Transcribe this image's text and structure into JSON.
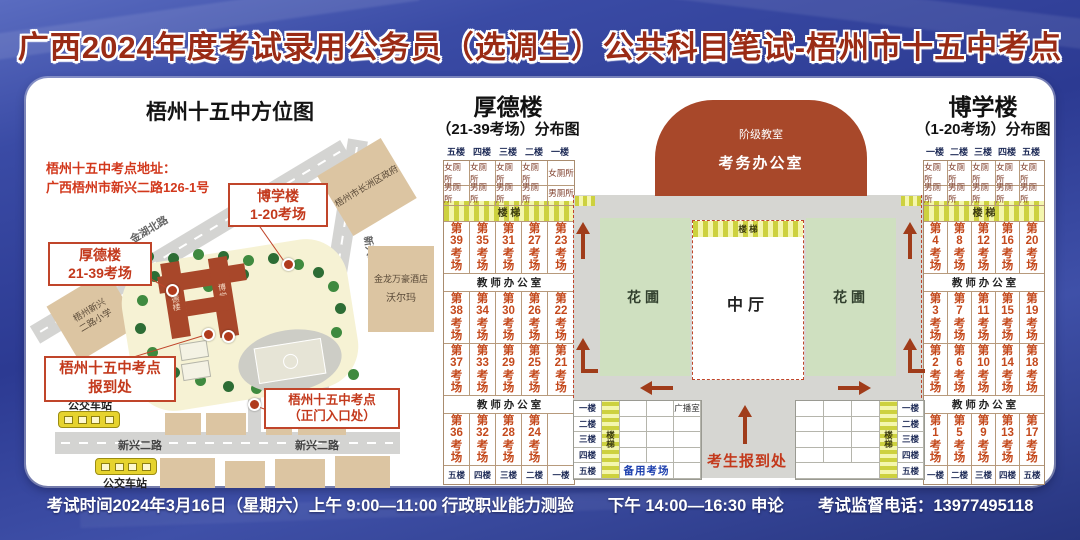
{
  "title": "广西2024年度考试录用公务员（选调生）公共科目笔试-梧州市十五中考点",
  "footer": {
    "time": "考试时间2024年3月16日（星期六）上午 9:00—11:00 行政职业能力测验",
    "afternoon": "下午 14:00—16:30 申论",
    "phone": "考试监督电话：13977495118"
  },
  "colors": {
    "title_red": "#9a2b15",
    "accent_red": "#c3391c",
    "arrow_red": "#a03c1a",
    "stairs_yellow": "#e8eb7a",
    "garden_green": "#cfe0c0",
    "building_brick": "#a8472a",
    "backup_blue": "#1c3fae"
  },
  "map": {
    "title": "梧州十五中方位图",
    "address_line1": "梧州十五中考点地址：",
    "address_line2": "广西梧州市新兴二路126-1号",
    "callout_boxue_line1": "博学楼",
    "callout_boxue_line2": "1-20考场",
    "callout_houde_line1": "厚德楼",
    "callout_houde_line2": "21-39考场",
    "callout_baodao_line1": "梧州十五中考点",
    "callout_baodao_line2": "报到处",
    "callout_gate_line1": "梧州十五中考点",
    "callout_gate_line2": "（正门入口处）",
    "road_jinhu": "金湖北路",
    "road_xinxing_left": "新兴二路",
    "road_xinxing_right": "新兴二路",
    "road_xinxing_vertical": "新兴二路",
    "bldg_government": "梧州市长洲区政府",
    "bldg_hotel": "金龙万豪酒店",
    "bldg_walmart": "沃尔玛",
    "bldg_school_line1": "梧州新兴",
    "bldg_school_line2": "二路小学",
    "bus_stop_top": "公交车站",
    "bus_stop_bottom": "公交车站",
    "campus_houde": "厚德楼",
    "campus_boxue": "博学楼"
  },
  "houde": {
    "title": "厚德楼",
    "subtitle": "（21-39考场）分布图",
    "floors_top": [
      "五楼",
      "四楼",
      "三楼",
      "二楼",
      "一楼"
    ],
    "toilets_female": [
      "女厕所",
      "女厕所",
      "女厕所",
      "女厕所",
      "女厕所"
    ],
    "toilets_male": [
      "男厕所",
      "男厕所",
      "男厕所",
      "男厕所",
      "男厕所"
    ],
    "stairs": "楼 梯",
    "rooms_a": [
      "第39考场",
      "第35考场",
      "第31考场",
      "第27考场",
      "第23考场"
    ],
    "office1": "教 师 办 公 室",
    "rooms_b": [
      "第38考场",
      "第34考场",
      "第30考场",
      "第26考场",
      "第22考场"
    ],
    "rooms_c": [
      "第37考场",
      "第33考场",
      "第29考场",
      "第25考场",
      "第21考场"
    ],
    "office2": "教 师 办 公 室",
    "rooms_d": [
      "第36考场",
      "第32考场",
      "第28考场",
      "第24考场",
      ""
    ],
    "floors_bottom": [
      "五楼",
      "四楼",
      "三楼",
      "二楼",
      "一楼"
    ]
  },
  "boxue": {
    "title": "博学楼",
    "subtitle": "（1-20考场）分布图",
    "floors_top": [
      "一楼",
      "二楼",
      "三楼",
      "四楼",
      "五楼"
    ],
    "toilets_female": [
      "女厕所",
      "女厕所",
      "女厕所",
      "女厕所",
      "女厕所"
    ],
    "toilets_male": [
      "男厕所",
      "男厕所",
      "男厕所",
      "男厕所",
      "男厕所"
    ],
    "stairs": "楼 梯",
    "rooms_a": [
      "第4考场",
      "第8考场",
      "第12考场",
      "第16考场",
      "第20考场"
    ],
    "office1": "教 师 办 公 室",
    "rooms_b": [
      "第3考场",
      "第7考场",
      "第11考场",
      "第15考场",
      "第19考场"
    ],
    "rooms_c": [
      "第2考场",
      "第6考场",
      "第10考场",
      "第14考场",
      "第18考场"
    ],
    "office2": "教 师 办 公 室",
    "rooms_d": [
      "第1考场",
      "第5考场",
      "第9考场",
      "第13考场",
      "第17考场"
    ],
    "floors_bottom": [
      "一楼",
      "二楼",
      "三楼",
      "四楼",
      "五楼"
    ]
  },
  "center": {
    "lecture_hall": "阶级教室",
    "exam_office": "考务办公室",
    "hall_stairs": "楼 梯",
    "garden_left": "花圃",
    "garden_right": "花圃",
    "hall": "中厅",
    "checkin": "考生报到处",
    "left_table": {
      "floors": [
        "一楼",
        "二楼",
        "三楼",
        "四楼",
        "五楼"
      ],
      "stairs": "楼梯",
      "broadcast": "广播室",
      "backup": "备用考场"
    },
    "right_table": {
      "floors": [
        "一楼",
        "二楼",
        "三楼",
        "四楼",
        "五楼"
      ],
      "stairs": "楼梯"
    }
  }
}
